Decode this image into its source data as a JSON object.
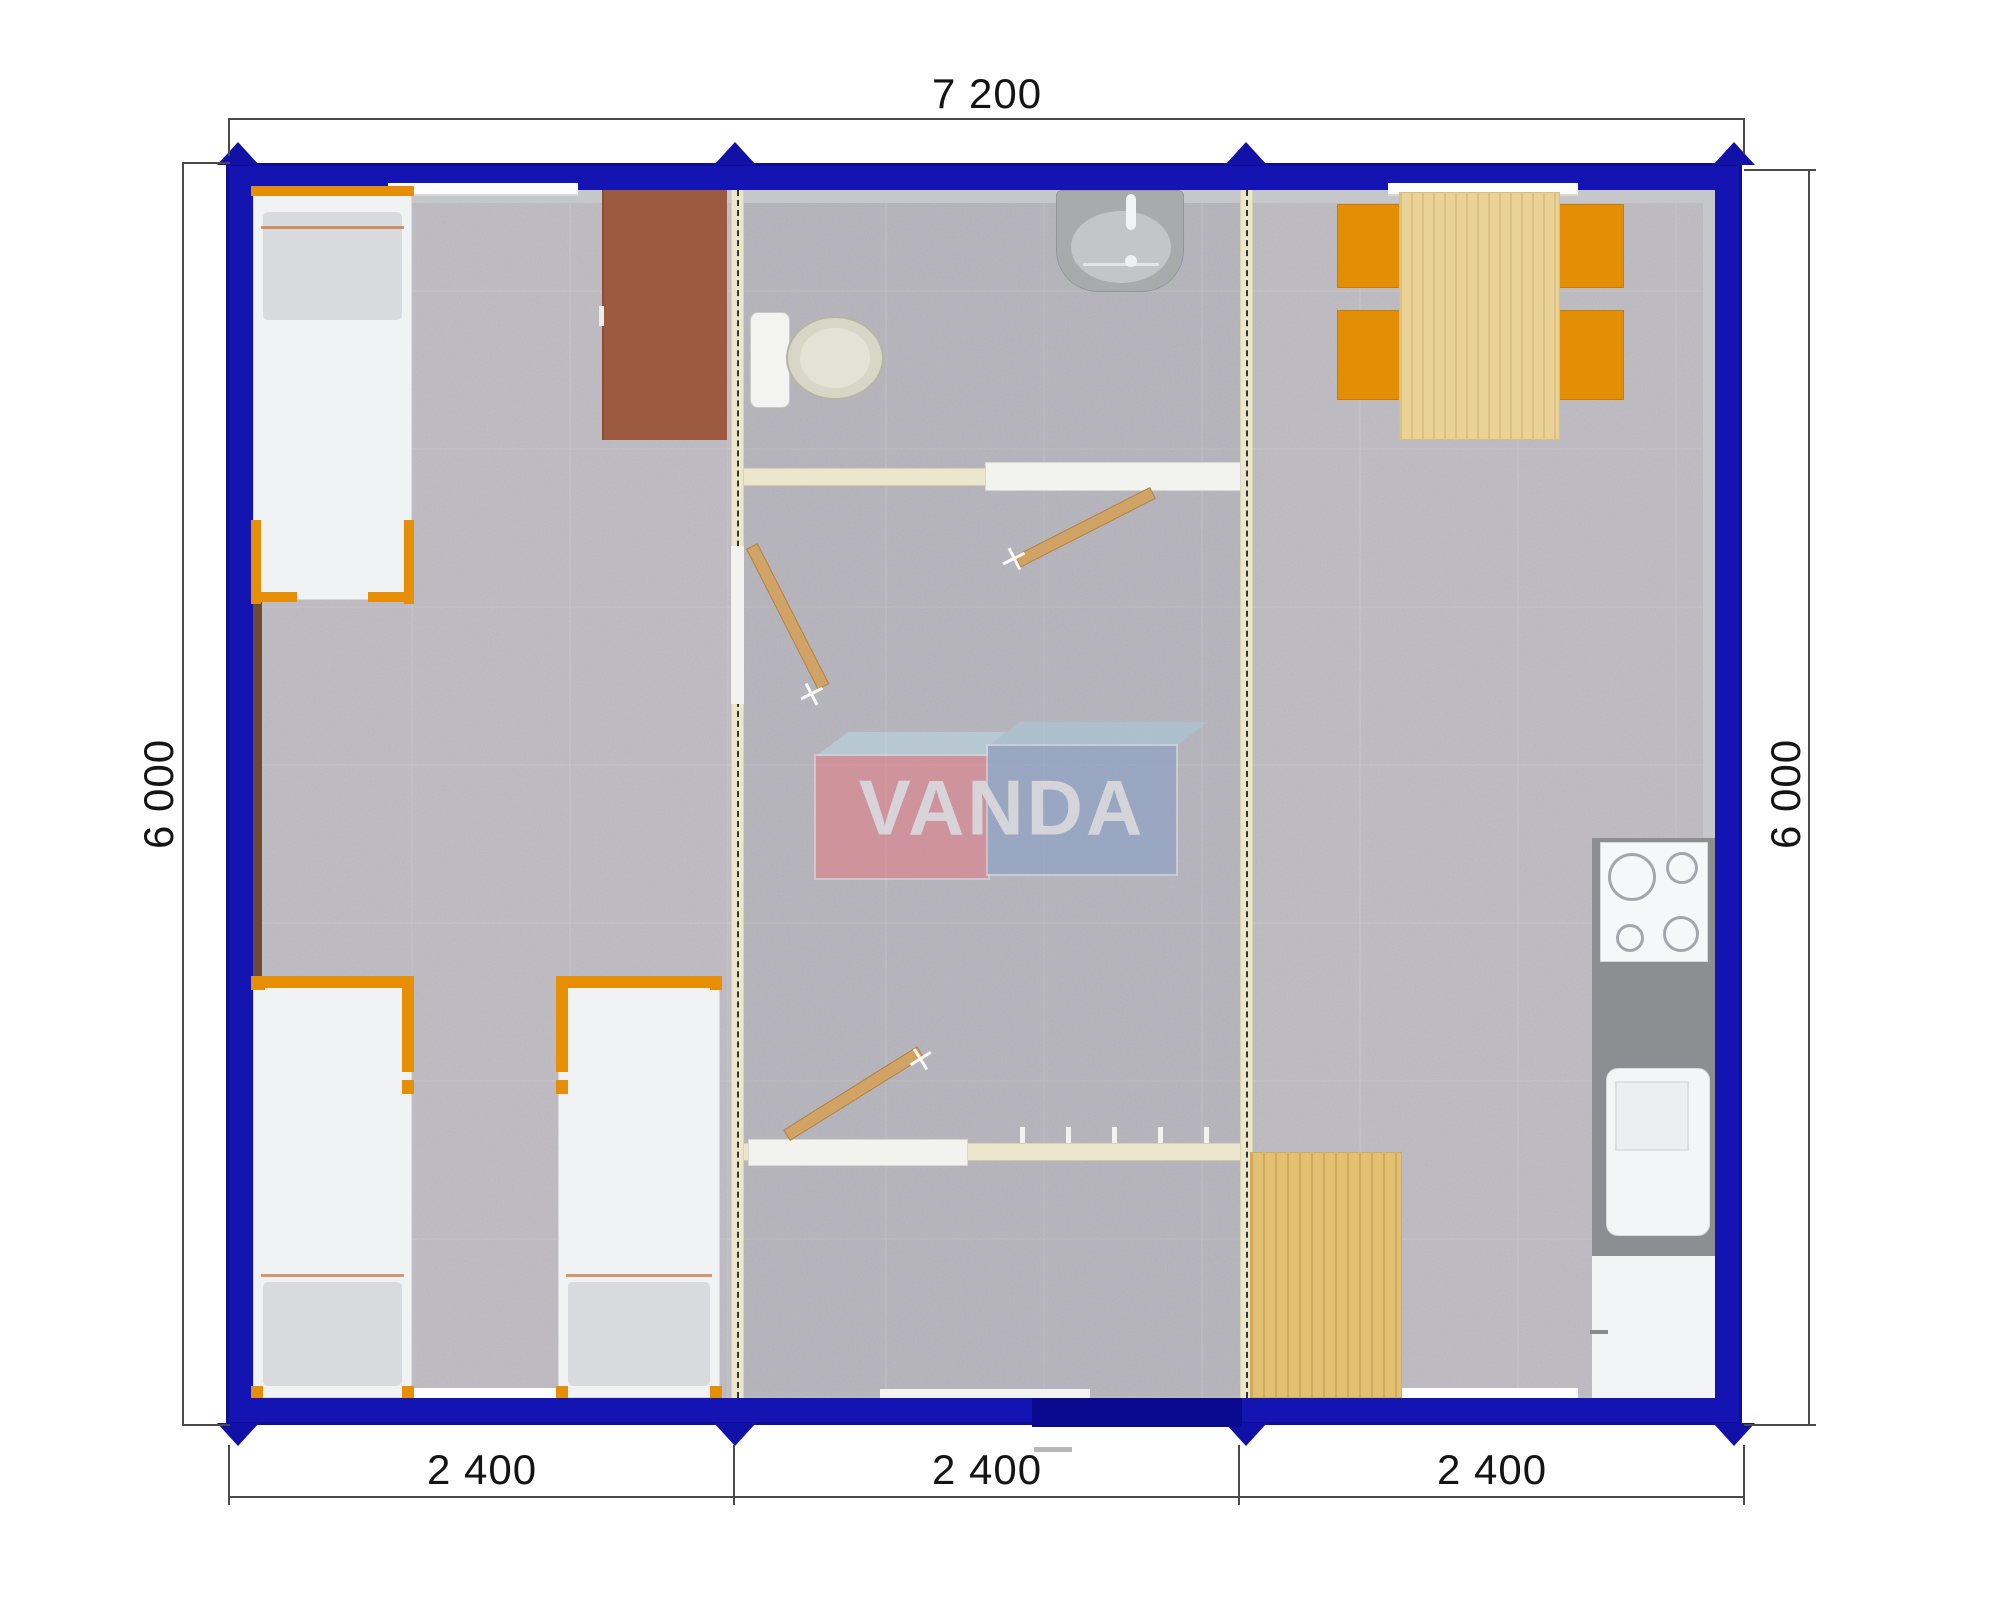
{
  "brand": "VANDA",
  "dimensions": {
    "top": "7 200",
    "left": "6 000",
    "right": "6 000",
    "bottom": [
      "2 400",
      "2 400",
      "2 400"
    ]
  },
  "modules": [
    {
      "name": "bedroom-module",
      "furniture": [
        "single-bed",
        "single-bed",
        "single-bed",
        "desk"
      ]
    },
    {
      "name": "bathroom-hall-module",
      "furniture": [
        "toilet",
        "wash-basin",
        "swing-door",
        "swing-door",
        "swing-door",
        "entrance-door"
      ]
    },
    {
      "name": "kitchen-dining-module",
      "furniture": [
        "dining-table",
        "chair",
        "chair",
        "chair",
        "chair",
        "stove",
        "kitchen-sink",
        "fridge",
        "wooden-mat"
      ]
    }
  ],
  "colors": {
    "frame_blue": "#1414b2",
    "entry_door_blue": "#0a0a8e",
    "accent_orange": "#e28f06",
    "partition_cream": "#ebe6cc",
    "floor_gray": "#bdbbc1",
    "counter_gray": "#8d8e92",
    "table_wood": "#ead196",
    "mat_wood": "#e3bf72",
    "door_wood": "#d1a465",
    "desk_brown": "#9c5a40",
    "logo_red": "#e7747e",
    "logo_blue": "#7e9bc8"
  }
}
